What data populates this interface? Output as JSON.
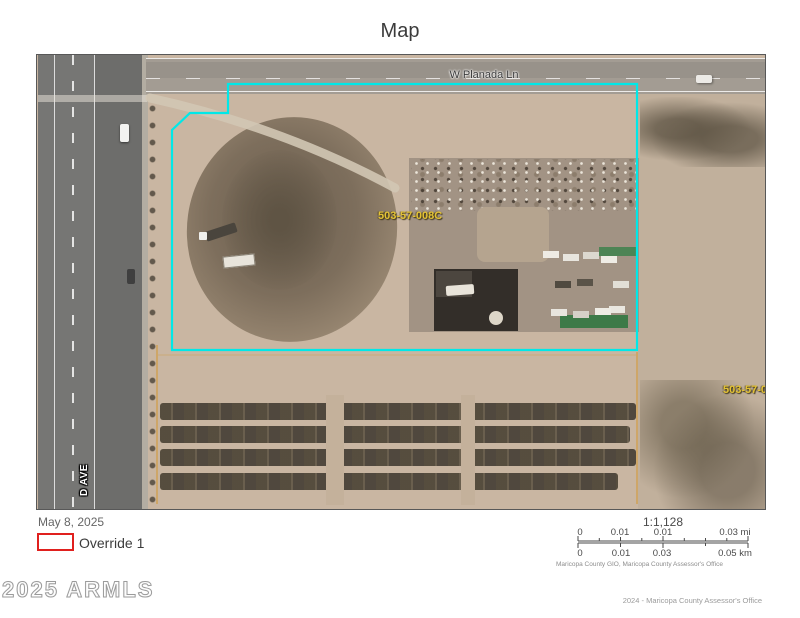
{
  "title": "Map",
  "map": {
    "street_label": "W Planada Ln",
    "parcel_label": "503-57-008C",
    "adjacent_parcel_label": "503-57-01",
    "road_label_vertical": "D AVE",
    "parcel_outline_color": "#00e8e8",
    "adjacent_line_color": "#d29a3a",
    "parcel_label_color": "#e3c235"
  },
  "legend": {
    "date": "May 8, 2025",
    "override_label": "Override 1",
    "override_color": "#e0201e"
  },
  "scalebar": {
    "ratio": "1:1,128",
    "mi_ticks": [
      "0",
      "0.01",
      "0.01",
      "0.03 mi"
    ],
    "km_ticks": [
      "0",
      "0.01",
      "0.03",
      "0.05 km"
    ],
    "sources": "Maricopa County GIO, Maricopa County Assessor's Office"
  },
  "watermark": "2025 ARMLS",
  "attribution": "2024 - Maricopa County Assessor's Office"
}
